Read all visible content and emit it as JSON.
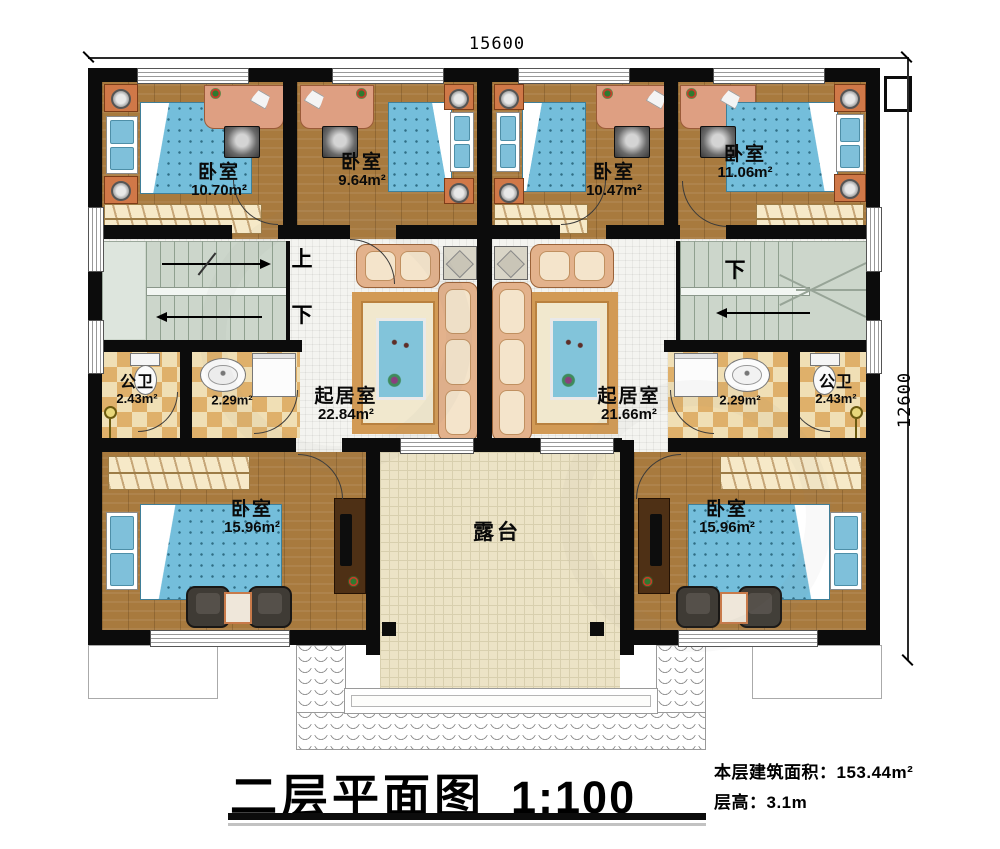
{
  "dimensions": {
    "width_total": "15600",
    "height_total": "12600"
  },
  "stair_labels": {
    "left_up": "上",
    "left_down": "下",
    "right_down": "下"
  },
  "rooms": {
    "bedroom_top_left": {
      "name": "卧室",
      "area": "10.70m²"
    },
    "bedroom_top_midleft": {
      "name": "卧室",
      "area": "9.64m²"
    },
    "bedroom_top_midright": {
      "name": "卧室",
      "area": "10.47m²"
    },
    "bedroom_top_right": {
      "name": "卧室",
      "area": "11.06m²"
    },
    "bath_left": {
      "name": "公卫",
      "area": "2.43m²"
    },
    "wash_left": {
      "area": "2.29m²"
    },
    "living_left": {
      "name": "起居室",
      "area": "22.84m²"
    },
    "living_right": {
      "name": "起居室",
      "area": "21.66m²"
    },
    "wash_right": {
      "area": "2.29m²"
    },
    "bath_right": {
      "name": "公卫",
      "area": "2.43m²"
    },
    "bedroom_bottom_left": {
      "name": "卧室",
      "area": "15.96m²"
    },
    "bedroom_bottom_right": {
      "name": "卧室",
      "area": "15.96m²"
    },
    "terrace": {
      "name": "露台"
    }
  },
  "title_block": {
    "title": "二层平面图",
    "scale": "1:100",
    "floor_area": "本层建筑面积：153.44m²",
    "floor_height": "层高：3.1m"
  },
  "colors": {
    "wall": "#0c0c0c",
    "wood": "#a87a3e",
    "tile": "#f4f4f0",
    "stair": "#ccd6cb",
    "checker-a": "#f0dfb5",
    "checker-b": "#dfb06a",
    "terrace": "#ece3c6",
    "bed": "#74bedb",
    "sofa": "#e3b28c",
    "cushion": "#f4e4cb",
    "desk": "#de9f82",
    "carpet": "#d29a55",
    "rug": "#82c4da",
    "closet": "#f6e9c8",
    "darkwood": "#4e3015"
  }
}
